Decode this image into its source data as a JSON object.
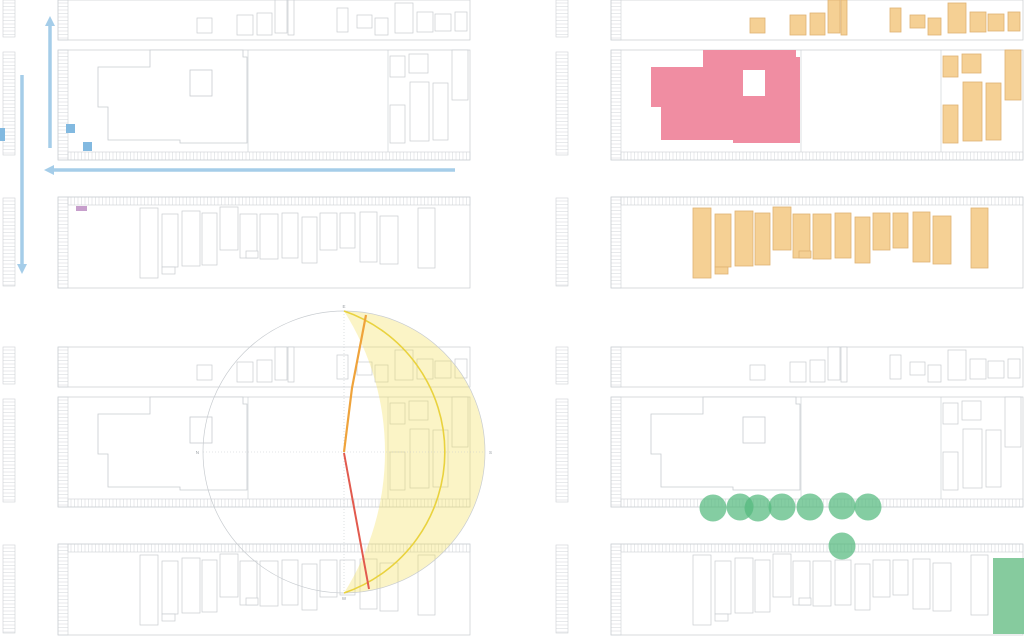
{
  "document": {
    "type": "site-analysis-diagram-sheet",
    "panels": [
      {
        "id": "circulation",
        "name": "circulation-analysis"
      },
      {
        "id": "uses",
        "name": "building-use-analysis"
      },
      {
        "id": "solar",
        "name": "solar-path-analysis"
      },
      {
        "id": "landscape",
        "name": "landscape-trees-analysis"
      }
    ]
  },
  "colors": {
    "background": "#ffffff",
    "outline_gray": "#c8ccd0",
    "hatch_gray": "#cdd0d4",
    "arrow_blue": "#a5cde9",
    "square_blue": "#82b9e0",
    "marker_purple": "#c79fcc",
    "building_pink": "#f08da2",
    "building_orange": "#f5d094",
    "building_orange_stroke": "#dfb273",
    "sun_fill_yellow": "#f2dc4e",
    "sun_arc_yellow": "#e9d23e",
    "sunrise_orange": "#efa33b",
    "sunset_red": "#e25a4e",
    "tree_green": "#55ba7e",
    "greenspace_green": "#7fc899",
    "compass_gray": "#9aa0a5"
  },
  "base_map": {
    "block_outlines": [
      [
        58,
        0,
        412,
        40
      ],
      [
        58,
        50,
        412,
        110
      ],
      [
        58,
        197,
        412,
        91
      ]
    ],
    "parcel_lines": [
      [
        248,
        50,
        248,
        152
      ],
      [
        388,
        50,
        388,
        152
      ]
    ],
    "ladder_strips": [
      [
        3,
        0,
        12,
        37
      ],
      [
        3,
        52,
        12,
        103
      ],
      [
        3,
        198,
        12,
        88
      ],
      [
        58,
        0,
        10,
        40
      ],
      [
        58,
        50,
        10,
        110
      ],
      [
        58,
        197,
        10,
        91
      ]
    ],
    "comb_strips": [
      [
        68,
        152,
        402,
        8
      ],
      [
        68,
        197,
        402,
        8
      ]
    ],
    "main_building": {
      "points": "98,67 150,67 150,50 243,50 243,57 247,57 247,143 180,143 180,140 108,140 108,107 98,107",
      "courtyard": [
        190,
        70,
        22,
        26
      ]
    },
    "context_buildings": {
      "top_row": [
        [
          197,
          18,
          15,
          15
        ],
        [
          237,
          15,
          16,
          20
        ],
        [
          257,
          13,
          15,
          22
        ],
        [
          275,
          0,
          12,
          33
        ],
        [
          288,
          0,
          6,
          35
        ],
        [
          337,
          8,
          11,
          24
        ],
        [
          357,
          15,
          15,
          13
        ],
        [
          375,
          18,
          13,
          17
        ],
        [
          395,
          3,
          18,
          30
        ],
        [
          417,
          12,
          16,
          20
        ],
        [
          435,
          14,
          16,
          17
        ],
        [
          455,
          12,
          12,
          19
        ]
      ],
      "right_cluster": [
        [
          390,
          56,
          15,
          21
        ],
        [
          409,
          54,
          19,
          19
        ],
        [
          452,
          50,
          16,
          50
        ],
        [
          410,
          82,
          19,
          59
        ],
        [
          433,
          83,
          15,
          57
        ],
        [
          390,
          105,
          15,
          38
        ]
      ],
      "houses": [
        [
          140,
          208,
          18,
          70
        ],
        [
          162,
          214,
          16,
          53
        ],
        [
          182,
          211,
          18,
          55
        ],
        [
          202,
          213,
          15,
          52
        ],
        [
          220,
          207,
          18,
          43
        ],
        [
          240,
          214,
          17,
          44
        ],
        [
          260,
          214,
          18,
          45
        ],
        [
          282,
          213,
          16,
          45
        ],
        [
          302,
          217,
          15,
          46
        ],
        [
          320,
          213,
          17,
          37
        ],
        [
          340,
          213,
          15,
          35
        ],
        [
          360,
          212,
          17,
          50
        ],
        [
          380,
          216,
          18,
          48
        ],
        [
          418,
          208,
          17,
          60
        ]
      ],
      "house_annexes": [
        [
          162,
          267,
          13,
          7
        ],
        [
          246,
          251,
          12,
          7
        ]
      ]
    }
  },
  "quadrants": [
    {
      "id": "circulation",
      "size": [
        512,
        300
      ],
      "map_offset": [
        0,
        0
      ],
      "mode": "outline",
      "overlays": {
        "arrows": [
          {
            "pts": [
              [
                50,
                148
              ],
              [
                50,
                16
              ]
            ]
          },
          {
            "pts": [
              [
                22,
                75
              ],
              [
                22,
                274
              ]
            ]
          },
          {
            "pts": [
              [
                455,
                170
              ],
              [
                44,
                170
              ]
            ]
          }
        ],
        "blue_squares": [
          [
            66,
            124,
            9,
            9
          ],
          [
            83,
            142,
            9,
            9
          ],
          [
            0,
            128,
            5,
            13
          ]
        ],
        "purple_marker": [
          76,
          206,
          11,
          5
        ]
      }
    },
    {
      "id": "uses",
      "size": [
        512,
        300
      ],
      "map_offset": [
        41,
        0
      ],
      "mode": "uses",
      "overlays": {}
    },
    {
      "id": "solar",
      "size": [
        512,
        337
      ],
      "map_offset": [
        0,
        47
      ],
      "mode": "outline",
      "overlays": {
        "sun": {
          "center": [
            344,
            152
          ],
          "radius": 141,
          "crescent_path": "M344,11 A141,141 0 0 1 344,293 A263,263 0 0 0 344,11 Z",
          "equinox_path": "M344,11 A149,149 0 0 1 344,293",
          "axes": [
            [
              203,
              152,
              485,
              152
            ],
            [
              344,
              11,
              344,
              293
            ]
          ],
          "sunrise_pts": "344,152 352,88 366,15",
          "sunset_pts": "344,153 369,289",
          "compass": [
            {
              "label": "E",
              "x": 344,
              "y": 8,
              "anchor": "middle"
            },
            {
              "label": "N",
              "x": 199,
              "y": 154,
              "anchor": "end"
            },
            {
              "label": "S",
              "x": 489,
              "y": 154,
              "anchor": "start"
            },
            {
              "label": "W",
              "x": 344,
              "y": 300,
              "anchor": "middle"
            }
          ]
        }
      }
    },
    {
      "id": "landscape",
      "size": [
        512,
        337
      ],
      "map_offset": [
        41,
        47
      ],
      "mode": "outline",
      "overlays": {
        "trees": {
          "radius": 13.5,
          "centers": [
            [
              201,
              208
            ],
            [
              228,
              207
            ],
            [
              246,
              208
            ],
            [
              270,
              207
            ],
            [
              298,
              207
            ],
            [
              330,
              206
            ],
            [
              356,
              207
            ],
            [
              330,
              246
            ]
          ]
        },
        "greenspace": [
          481,
          258,
          31,
          76
        ]
      }
    }
  ]
}
